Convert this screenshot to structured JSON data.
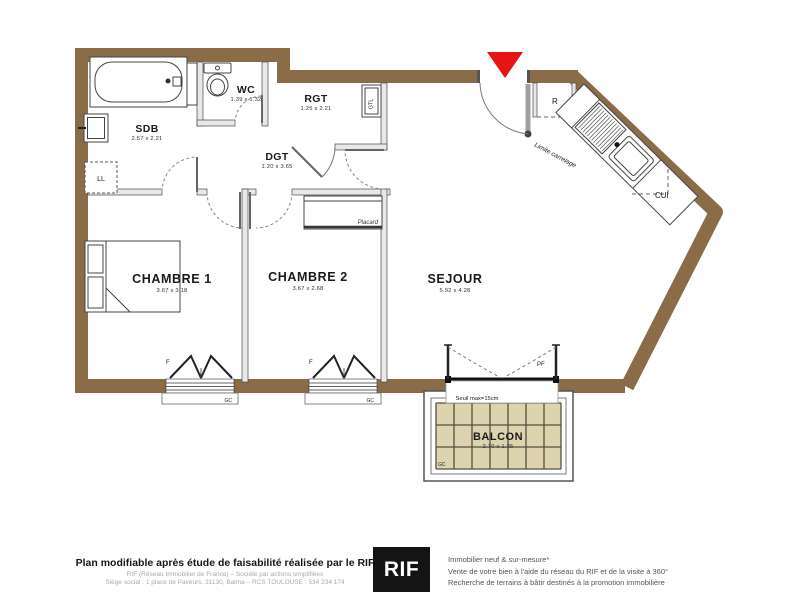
{
  "plan": {
    "rooms": {
      "sdb": {
        "name": "SDB",
        "dims": "2.57 x 2.21"
      },
      "wc": {
        "name": "WC",
        "dims": "1.39 x 1.32"
      },
      "rgt": {
        "name": "RGT",
        "dims": "1.25 x 2.21"
      },
      "dgt": {
        "name": "DGT",
        "dims": "1.20 x 3.65"
      },
      "chambre1": {
        "name": "CHAMBRE 1",
        "dims": "3.67 x 3.18"
      },
      "chambre2": {
        "name": "CHAMBRE 2",
        "dims": "3.67 x 2.68"
      },
      "sejour": {
        "name": "SEJOUR",
        "dims": "5.92 x 4.28"
      },
      "balcon": {
        "name": "BALCON",
        "dims": "2.70 x 1.35"
      },
      "cui": {
        "name": "CUI"
      }
    },
    "labels": {
      "ll": "LL",
      "gtl": "GTL",
      "r": "R",
      "placard": "Placard",
      "limite_carrelage": "Limite carrelage",
      "pf": "PF",
      "f": "F",
      "gc": "GC",
      "seuil": "Seuil max=15cm"
    },
    "colors": {
      "wall": "#8a6c49",
      "balcony_tile": "#ddd3ae",
      "entrance_marker": "#e51414"
    }
  },
  "footer": {
    "left": {
      "line1": "Plan modifiable après étude de faisabilité réalisée par le RIF",
      "line2": "RIF (Réseau Immobilier de France) – Société par actions simplifiées",
      "line3": "Siège social : 1 place de Paveurs, 31130, Balma – RCS TOULOUSE : 534 234 174"
    },
    "logo": "RIF",
    "right": {
      "line1": "Immobilier neuf & sur-mesure*",
      "line2": "Vente de votre bien à l'aide du réseau du RIF et de la visite à 360°",
      "line3": "Recherche de terrains à bâtir destinés à la promotion immobilière"
    }
  }
}
